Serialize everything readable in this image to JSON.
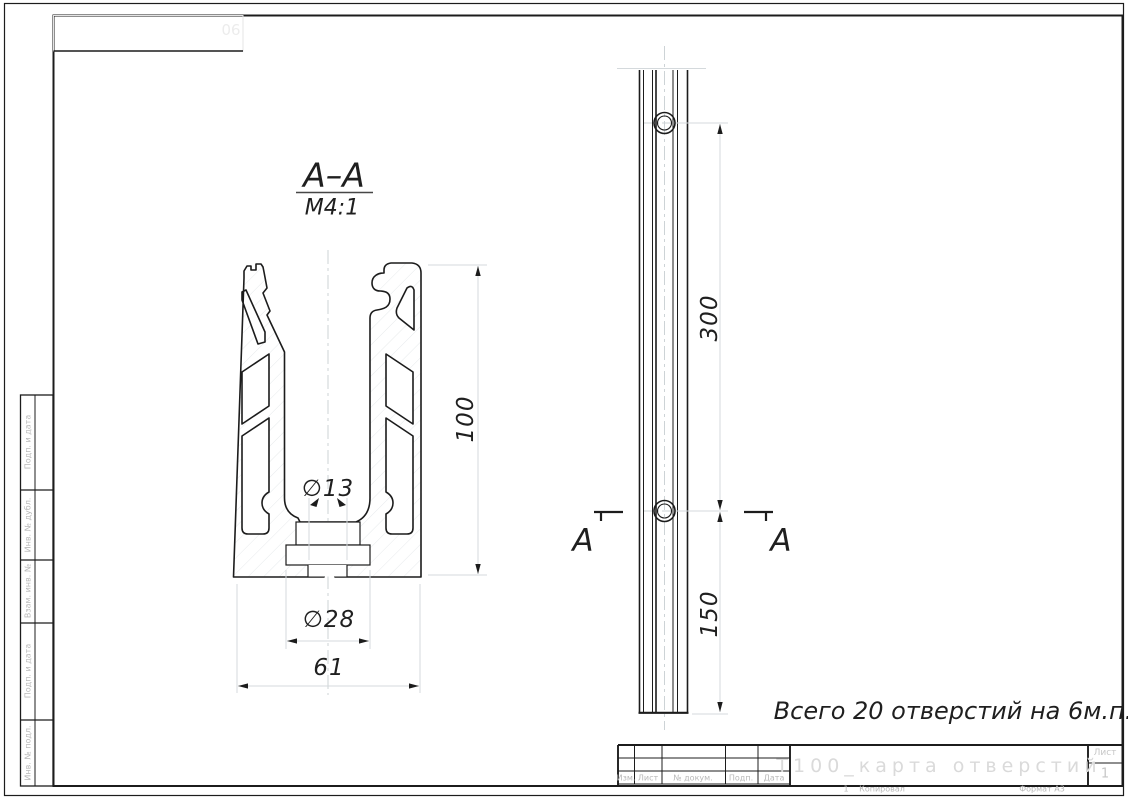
{
  "drawing": {
    "section_label": "А–А",
    "scale_label": "М4:1",
    "note": "Всего 20 отверстий на 6м.п.",
    "section_mark_left": "А",
    "section_mark_right": "А",
    "dims": {
      "profile_height": "100",
      "hole_diameter": "∅13",
      "channel_width": "∅28",
      "profile_width": "61",
      "hole_spacing": "300",
      "end_offset": "150"
    }
  },
  "title_block": {
    "title": "Т100_карта отверстий",
    "sheet_label": "Лист",
    "sheet_number": "1",
    "columns": [
      "Изм.",
      "Лист",
      "№ докум.",
      "Подп.",
      "Дата"
    ],
    "footer_copy_num": "1",
    "footer_copied": "Копировал",
    "footer_format": "Формат А3"
  },
  "side_fields": [
    "Подп. и дата",
    "Инв. № дубл.",
    "Взам. инв. №",
    "Подп. и дата",
    "Инв. № подл."
  ],
  "corner_stamp": "90",
  "colors": {
    "line": "#1c1c1c",
    "thin_aux": "#d4d9dc",
    "hatch": "#e7eaec",
    "gray_text": "#b9b9b9"
  }
}
